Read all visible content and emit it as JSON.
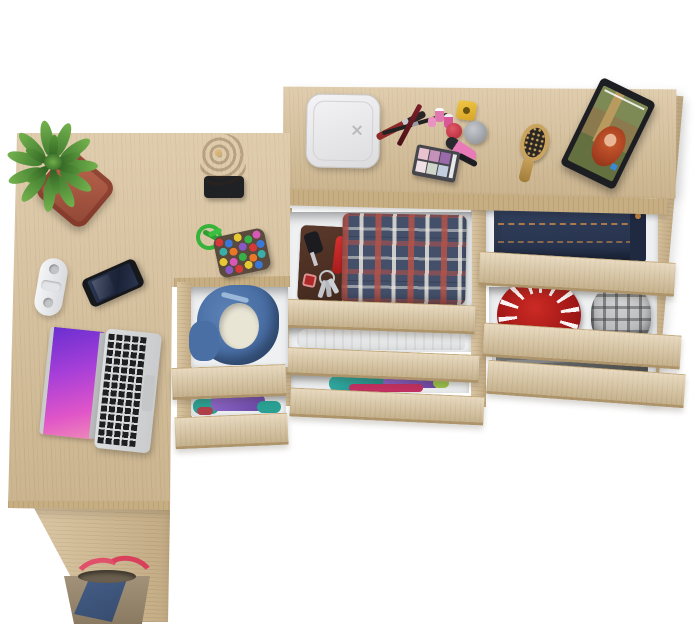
{
  "scene": {
    "type": "furniture-product-photo",
    "description": "Top-down render of an L-shaped light oak desk joined to a wide dresser; all drawers pulled open revealing folded clothes and accessories",
    "background_color": "#ffffff",
    "wood_color": "#d7bf97",
    "wood_edge_color": "#c7ae82",
    "drawer_interior_color": "#eef0f1"
  },
  "furniture": {
    "desk": {
      "label": "L-shaped oak desk"
    },
    "desk_side_panel": {
      "label": "desk support panel"
    },
    "side_cabinet": {
      "label": "under-desk drawer unit with 2 open drawers"
    },
    "dresser": {
      "label": "oak dresser with 6 open drawers"
    }
  },
  "objects": {
    "potted_plant": {
      "label": "green succulent in terracotta pot",
      "pot_color": "#b05a44",
      "leaf_color": "#4d8a35"
    },
    "power_strip": {
      "label": "white power strip",
      "color": "#f0f1f3"
    },
    "smartphone": {
      "label": "black smartphone",
      "color": "#17181c",
      "screen_color": "#232c44"
    },
    "laptop": {
      "label": "silver laptop with open lid",
      "body_color": "#d6d8da",
      "screen_colors": "#6a2fd0 #e055c8"
    },
    "wooden_stump": {
      "label": "decorative wood stump on black stand",
      "color": "#8a5a30"
    },
    "bead_pouch": {
      "label": "multicolor bead pouch with green cord",
      "cord_color": "#35b33a"
    },
    "scale_box": {
      "label": "white bathroom scale",
      "color": "#eeeef0"
    },
    "makeup_brushes": {
      "label": "makeup brushes",
      "colors": "#8e2a2a #222222"
    },
    "nail_polish_yellow": {
      "label": "yellow nail polish",
      "color": "#e8b838"
    },
    "nail_polish_red": {
      "label": "red nail polish",
      "color": "#cc3a50"
    },
    "nail_polish_pink": {
      "label": "small pink nail polishes",
      "color": "#e07aae"
    },
    "cream_jar": {
      "label": "silver cosmetic jar",
      "color": "#a8abb0"
    },
    "lipstick": {
      "label": "pink lipstick tube",
      "color": "#e87ab8"
    },
    "mascara": {
      "label": "black mascara",
      "color": "#1d1d22"
    },
    "eyeshadow_palette": {
      "label": "eyeshadow palette with pink and purple pans",
      "case_color": "#46474d"
    },
    "hairbrush": {
      "label": "wooden hairbrush",
      "color": "#caa35e"
    },
    "tablet": {
      "label": "tablet playing a video of a red-haired girl",
      "bezel_color": "#1d1e22"
    },
    "wallet": {
      "label": "brown leather wallet",
      "color": "#55362a"
    },
    "car_key": {
      "label": "black car key fob",
      "color": "#1c1c20"
    },
    "pocket_knife": {
      "label": "red pocket knife",
      "color": "#cc2525"
    },
    "keys": {
      "label": "key ring with keys",
      "color": "#c3c6cb"
    },
    "plaid_shirt": {
      "label": "folded red-navy plaid shirt",
      "colors": "#44506a #b45248"
    },
    "towel": {
      "label": "folded beige towel",
      "color": "#cfc8ba"
    },
    "folded_clothes_left": {
      "label": "folded teal, purple and magenta clothes",
      "colors": "#2fa8a0 #8a5fc0 #c03060"
    },
    "jeans": {
      "label": "folded dark blue jeans",
      "color": "#2e3c59"
    },
    "red_hat": {
      "label": "red hat with white pattern",
      "color": "#b01f1f"
    },
    "gray_cap": {
      "label": "gray plaid cap",
      "color": "#b9babc"
    },
    "dark_garment": {
      "label": "folded dark gray garment",
      "color": "#5f6164"
    },
    "hoodie": {
      "label": "blue hoodie folded around cream lining",
      "colors": "#4a6fa5 #e8e5d5"
    },
    "purple_clothes": {
      "label": "folded purple and teal clothes",
      "colors": "#7a58b8 #2aa093"
    },
    "handbag": {
      "label": "navy and taupe handbag with red straps",
      "colors": "#3e5878 #99896e #e0506a"
    }
  }
}
